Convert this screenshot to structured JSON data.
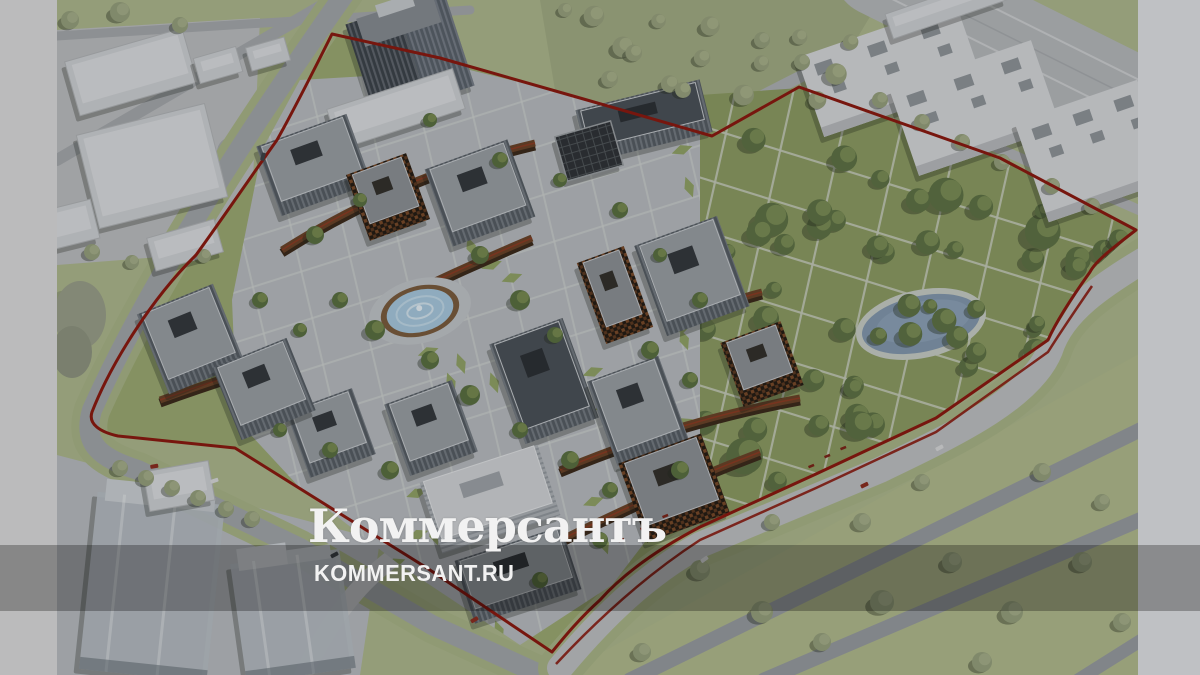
{
  "watermark": {
    "brand": "Коммерсантъ",
    "site": "KOMMERSANT.RU"
  },
  "colors": {
    "boundary_red": "#8c190e",
    "pond_blue": "#8399ae",
    "fountain_blue": "#a8cadf",
    "park_green": "#8d9d62",
    "site_green": "#9cab72",
    "context_green": "#aeb98d",
    "plaza_gray": "#b9bdc0",
    "road_gray": "#a3a7aa",
    "building_roof_gray": "#9aa0a4",
    "building_facade_dark": "#565d63",
    "accent_brown": "#6b4327",
    "context_building_white": "#d7d9db",
    "side_band_gray": "#dddddd",
    "watermark_white": "#f2f2f2"
  }
}
